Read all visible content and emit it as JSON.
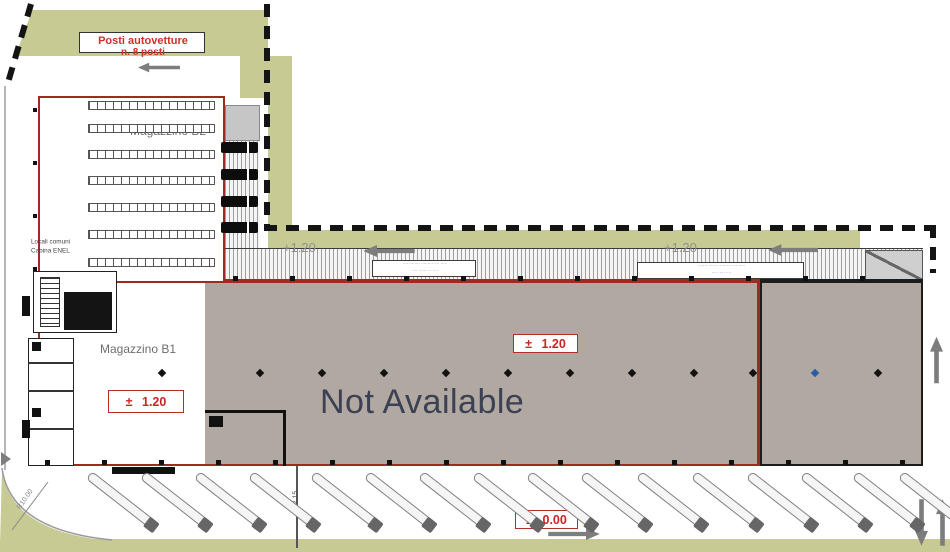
{
  "colors": {
    "green": "#c7ca93",
    "hall_gray": "#b1a8a2",
    "red_outline": "#9e2a20",
    "red_text": "#cc2424",
    "dark_text": "#3b4152",
    "gray_text": "#919191"
  },
  "site": {
    "parking": {
      "line1": "Posti autovetture",
      "line2": "n. 8 posti",
      "stall_count": 8
    },
    "warehouse_b2": {
      "label": "Magazzino B2"
    },
    "warehouse_b1": {
      "label": "Magazzino B1",
      "elevation": "± 1.20"
    },
    "technical": {
      "line1": "Locali comuni",
      "line2": "Cabina ENEL"
    },
    "main_hall": {
      "status": "Not Available",
      "elevation": "± 1.20"
    },
    "yard": {
      "elevation": "± 0.00"
    },
    "canopy": {
      "level_left": "+1.20",
      "level_right": "+1.20",
      "note_left_l1": "···· ········ ········· ···· ·····",
      "note_left_l2": "···· ······· ·· ····",
      "note_right_l1": "······· ········ ········· ·········",
      "note_right_l2": "···· ····· ····"
    },
    "dims": {
      "vertical": "12.15",
      "radius": "R10.00"
    }
  },
  "markers": {
    "rack_rows_y": [
      101,
      124,
      150,
      176,
      203,
      230,
      258
    ],
    "dock_trucks_y": [
      142,
      169,
      196,
      222
    ],
    "apron_trucks_x": [
      92,
      146,
      200,
      254,
      316,
      370,
      424,
      478,
      532,
      586,
      642,
      697,
      752,
      806,
      858,
      904
    ],
    "diamond_xs": [
      162,
      260,
      322,
      384,
      446,
      508,
      570,
      632,
      694,
      753,
      878
    ],
    "blue_diamond_x": 815,
    "diamond_y": 373,
    "top_dots": {
      "y": 276,
      "x_start": 233,
      "x_end": 915,
      "step": 57
    },
    "bottom_dots": {
      "y": 460,
      "x_start": 45,
      "x_end": 915,
      "step": 57
    },
    "left_dots": {
      "x": 33,
      "y_start": 108,
      "y_end": 268,
      "step": 53
    }
  }
}
